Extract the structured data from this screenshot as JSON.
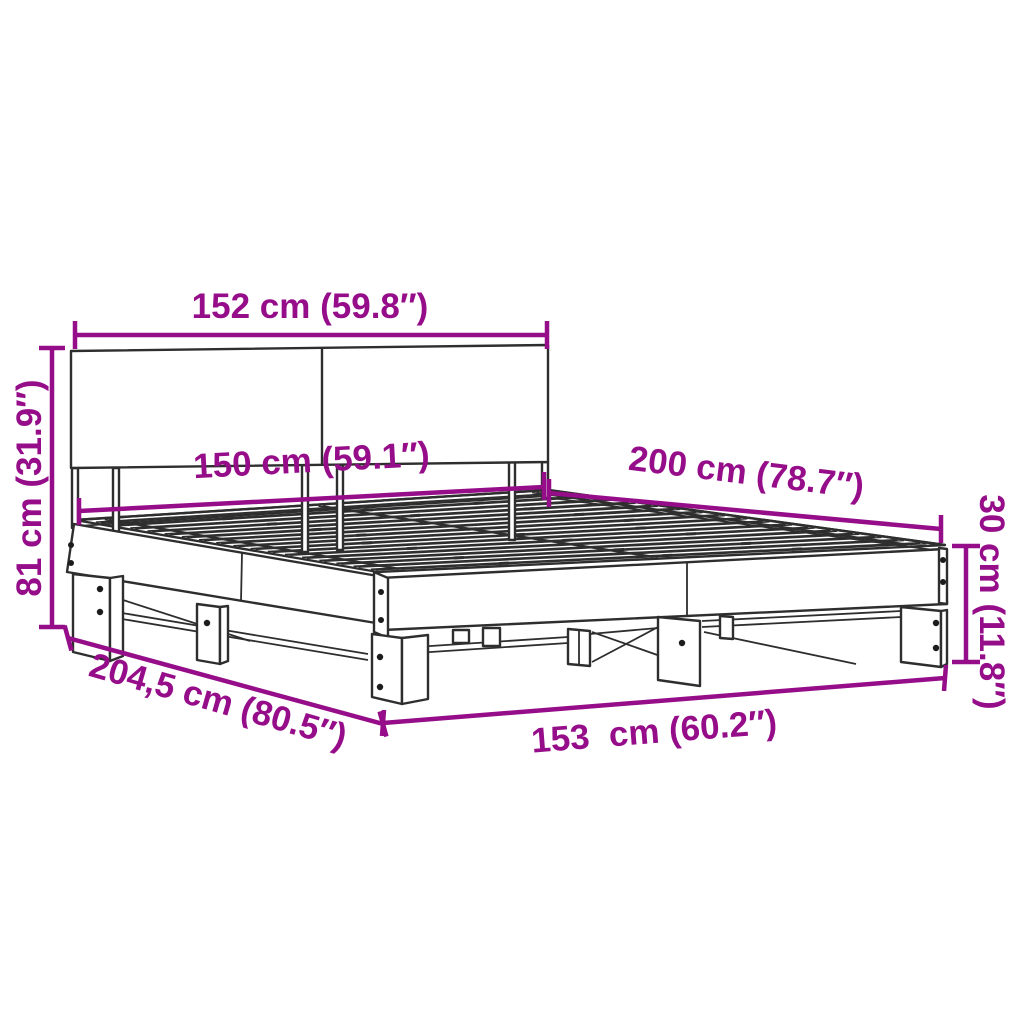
{
  "labels": {
    "headboard_width": "152 cm (59.8″)",
    "headboard_height": "81 cm (31.9″)",
    "slat_base_width": "150 cm (59.1″)",
    "bed_length": "200 cm (78.7″)",
    "frame_height": "30 cm (11.8″)",
    "total_length": "204,5 cm (80.5″)",
    "total_width": "153  cm (60.2″)"
  },
  "colors": {
    "dimension": "#960D89",
    "outline": "#2E2E2E",
    "background": "#FFFFFF"
  }
}
